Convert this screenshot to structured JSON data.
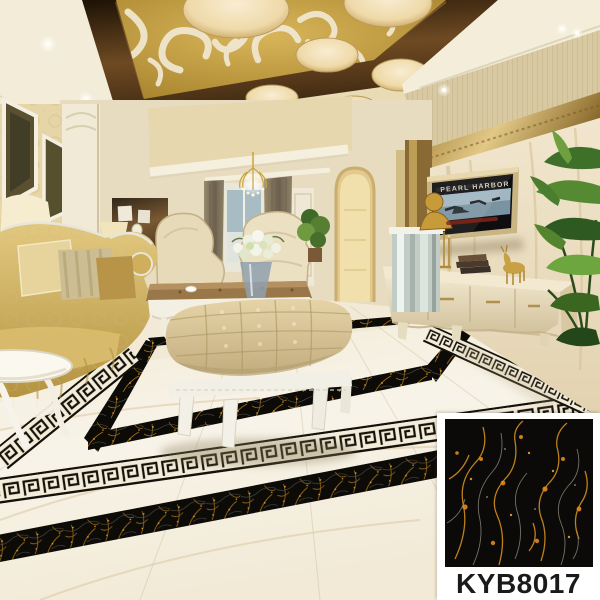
{
  "product_card": {
    "code": "KYB8017",
    "label_color": "#1a1a1a",
    "card_bg": "#ffffff",
    "tile_base_color": "#0b0a08",
    "tile_vein_gold": "#c8871d",
    "tile_vein_orange": "#e08a1e",
    "tile_vein_light": "#8d8d7f"
  },
  "tv": {
    "poster_title": "PEARL HARBOR",
    "frame_color": "#c9b483",
    "screen_color": "#0e0e10",
    "poster_accent_red": "#8a2418"
  },
  "room_palette": {
    "floor_marble": "#f2ead6",
    "floor_border_black_marble": "#0d0b08",
    "greek_key_field": "#f2ecda",
    "greek_key_line": "#161209",
    "ceiling_gold_panel": "#c19a3c",
    "ceiling_scroll_white": "#f1e9d2",
    "ceiling_wood_frame": "#4a3015",
    "wall_beige": "#e8dcc0",
    "tv_wall_marble": "#ecdfc5",
    "sofa_gold_damask": "#d2b168",
    "ottoman_leather": "#d9c69a",
    "armchair_cream": "#ece0c2",
    "curtain_taupe": "#8d8066",
    "plant_green": "#3f7029",
    "gold_trim": "#b8934a",
    "furniture_white": "#f2efe6"
  }
}
